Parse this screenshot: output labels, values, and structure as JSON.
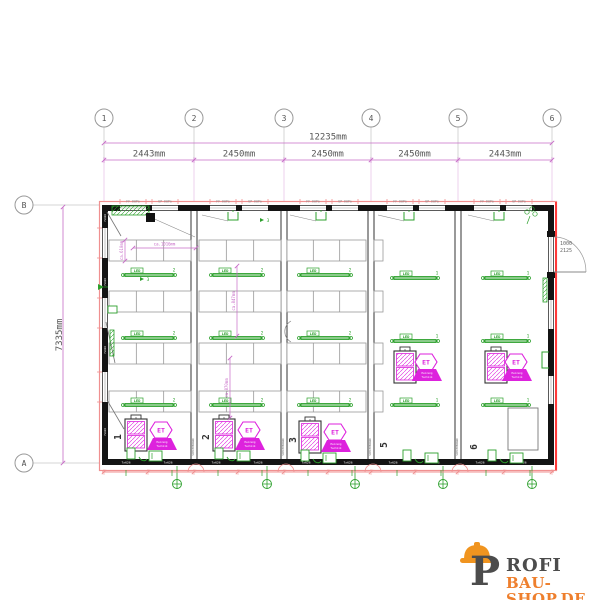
{
  "colors": {
    "salmon": "#f09090",
    "bright_red": "#ff3a3a",
    "dim_magenta": "#c76bc7",
    "equip_magenta": "#dd22dd",
    "green": "#2ca02c",
    "green_fill": "#e8f6e8",
    "wall": "#141414",
    "table_gray": "#999999",
    "dim_text": "#555555",
    "grid_gray": "#aaaaaa",
    "logo_dark": "#4c4c4c",
    "logo_orange": "#ee7f2d",
    "helmet_orange": "#f0941f"
  },
  "grid": {
    "columns": {
      "labels": [
        "1",
        "2",
        "3",
        "4",
        "5",
        "6"
      ],
      "x": [
        104,
        194,
        284,
        371,
        458,
        552
      ],
      "circle_y": 118
    },
    "rows": {
      "labels": [
        "B",
        "A"
      ],
      "y": [
        205,
        463
      ],
      "circle_x": 24
    }
  },
  "dimensions": {
    "overall": {
      "label": "12235mm",
      "y": 143
    },
    "segments": {
      "labels": [
        "2443mm",
        "2450mm",
        "2450mm",
        "2450mm",
        "2443mm"
      ],
      "y": 160
    },
    "height": {
      "label": "7335mm",
      "x": 63
    },
    "door": {
      "width": "1000",
      "height": "2125"
    },
    "interior": [
      {
        "label": "ca.610mm",
        "type": "v",
        "x": 125,
        "y1": 240,
        "y2": 261
      },
      {
        "label": "ca.1016mm",
        "type": "h",
        "x1": 133,
        "x2": 196,
        "y": 248
      },
      {
        "label": "ca.847mm",
        "type": "v",
        "x": 237,
        "y1": 266,
        "y2": 336
      },
      {
        "label": "ca.870mm",
        "type": "v",
        "x": 230,
        "y1": 358,
        "y2": 418
      }
    ]
  },
  "plan": {
    "x": 102,
    "y": 205,
    "w": 452,
    "h": 260,
    "partitions": [
      194,
      284,
      371,
      458
    ],
    "partition_label": "SCHIEBEWAND",
    "wall_top_labels": [
      "FF 60Pa",
      "UP 60Pa"
    ],
    "wall_bottom_text": "7x626",
    "bay_numbers": [
      {
        "number": "1",
        "x": 121,
        "y": 437
      },
      {
        "number": "2",
        "x": 209,
        "y": 437
      },
      {
        "number": "3",
        "x": 296,
        "y": 440
      },
      {
        "number": "5",
        "x": 387,
        "y": 445
      },
      {
        "number": "6",
        "x": 477,
        "y": 447
      }
    ],
    "tables": {
      "rows_y": [
        240,
        291,
        343,
        391
      ],
      "h": 21,
      "spans": [
        [
          109,
          191
        ],
        [
          199,
          281
        ],
        [
          287,
          366
        ]
      ],
      "stub": [
        374,
        383
      ]
    },
    "led": {
      "label": "LED",
      "bars": [
        {
          "x": 123,
          "y": 269,
          "w": 52,
          "count": "2"
        },
        {
          "x": 123,
          "y": 332,
          "w": 52,
          "count": "2"
        },
        {
          "x": 123,
          "y": 399,
          "w": 52,
          "count": "2"
        },
        {
          "x": 211,
          "y": 269,
          "w": 52,
          "count": "2"
        },
        {
          "x": 211,
          "y": 332,
          "w": 52,
          "count": "2"
        },
        {
          "x": 211,
          "y": 399,
          "w": 52,
          "count": "2"
        },
        {
          "x": 299,
          "y": 269,
          "w": 52,
          "count": "2"
        },
        {
          "x": 299,
          "y": 332,
          "w": 52,
          "count": "2"
        },
        {
          "x": 299,
          "y": 399,
          "w": 52,
          "count": "2"
        },
        {
          "x": 392,
          "y": 272,
          "w": 46,
          "count": "1"
        },
        {
          "x": 392,
          "y": 335,
          "w": 46,
          "count": "1"
        },
        {
          "x": 392,
          "y": 399,
          "w": 46,
          "count": "1"
        },
        {
          "x": 483,
          "y": 272,
          "w": 46,
          "count": "1"
        },
        {
          "x": 483,
          "y": 335,
          "w": 46,
          "count": "1"
        },
        {
          "x": 483,
          "y": 399,
          "w": 46,
          "count": "1"
        }
      ]
    },
    "equipment": {
      "hex_label": "ET",
      "trap_lines": [
        "Heizung",
        "Technik"
      ],
      "units": [
        {
          "box": [
            125,
            419
          ],
          "hex": [
            161,
            430
          ],
          "trap": [
            147,
            438
          ]
        },
        {
          "box": [
            213,
            419
          ],
          "hex": [
            249,
            430
          ],
          "trap": [
            235,
            438
          ]
        },
        {
          "box": [
            299,
            421
          ],
          "hex": [
            335,
            432
          ],
          "trap": [
            321,
            440
          ]
        },
        {
          "box": [
            394,
            351
          ],
          "hex": [
            426,
            362
          ],
          "trap": [
            412,
            369
          ]
        },
        {
          "box": [
            485,
            351
          ],
          "hex": [
            516,
            362
          ],
          "trap": [
            502,
            369
          ]
        }
      ]
    },
    "seats_x": [
      127,
      215,
      301,
      403,
      488
    ],
    "seats_y": [
      448,
      448,
      450,
      450,
      450
    ],
    "top_fixtures_x": [
      228,
      316,
      404,
      494
    ],
    "leaders": [
      [
        150,
        217,
        195,
        237
      ],
      [
        202,
        215,
        228,
        221
      ],
      [
        290,
        215,
        316,
        221
      ],
      [
        378,
        215,
        404,
        221
      ],
      [
        468,
        215,
        494,
        221
      ]
    ],
    "left_diagonals": [
      [
        107,
        212,
        121,
        236
      ],
      [
        106,
        322,
        115,
        363
      ],
      [
        107,
        400,
        124,
        429
      ]
    ],
    "earth_x": [
      177,
      267,
      355,
      443,
      532
    ],
    "green_marks": [
      {
        "t": "3",
        "x": 268,
        "y": 222
      },
      {
        "t": "3",
        "x": 148,
        "y": 281
      }
    ],
    "storage_rect": [
      508,
      408,
      30,
      42
    ],
    "door": {
      "x": 548,
      "y1": 237,
      "y2": 272
    }
  },
  "logo": {
    "p": "P",
    "name": "ROFI",
    "domain": "BAU-SHOP.DE"
  }
}
